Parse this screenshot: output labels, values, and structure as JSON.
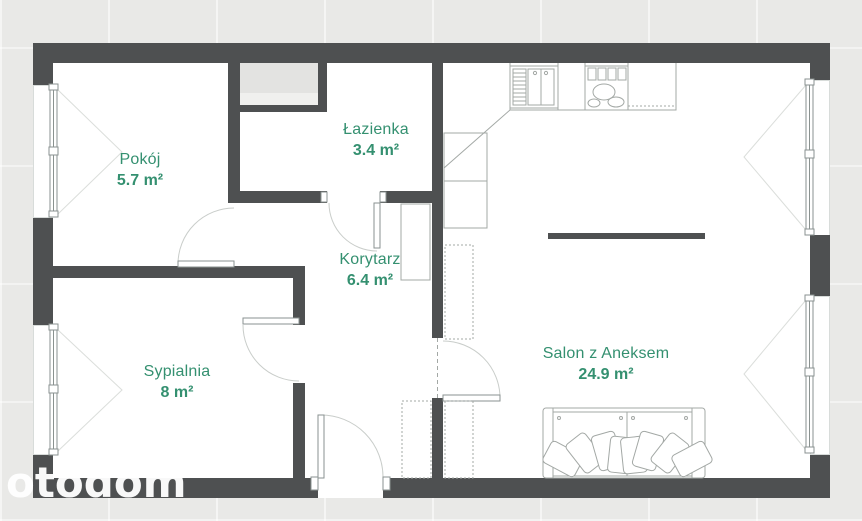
{
  "watermark": {
    "text": "otodom"
  },
  "colors": {
    "wall": "#4e5051",
    "room_label_green": "#349070",
    "background": "#e9e9e7",
    "floor": "#ffffff",
    "furniture_line": "#a3a8a5",
    "window_frame": "#8a9290",
    "shaft_fill": "#e3e3e1",
    "watermark": "#ffffff"
  },
  "rooms": [
    {
      "id": "pokoj",
      "name": "Pokój",
      "area": "5.7 m²"
    },
    {
      "id": "lazienka",
      "name": "Łazienka",
      "area": "3.4 m²"
    },
    {
      "id": "korytarz",
      "name": "Korytarz",
      "area": "6.4 m²"
    },
    {
      "id": "sypialnia",
      "name": "Sypialnia",
      "area": "8 m²"
    },
    {
      "id": "salon",
      "name": "Salon z Aneksem",
      "area": "24.9 m²"
    }
  ]
}
